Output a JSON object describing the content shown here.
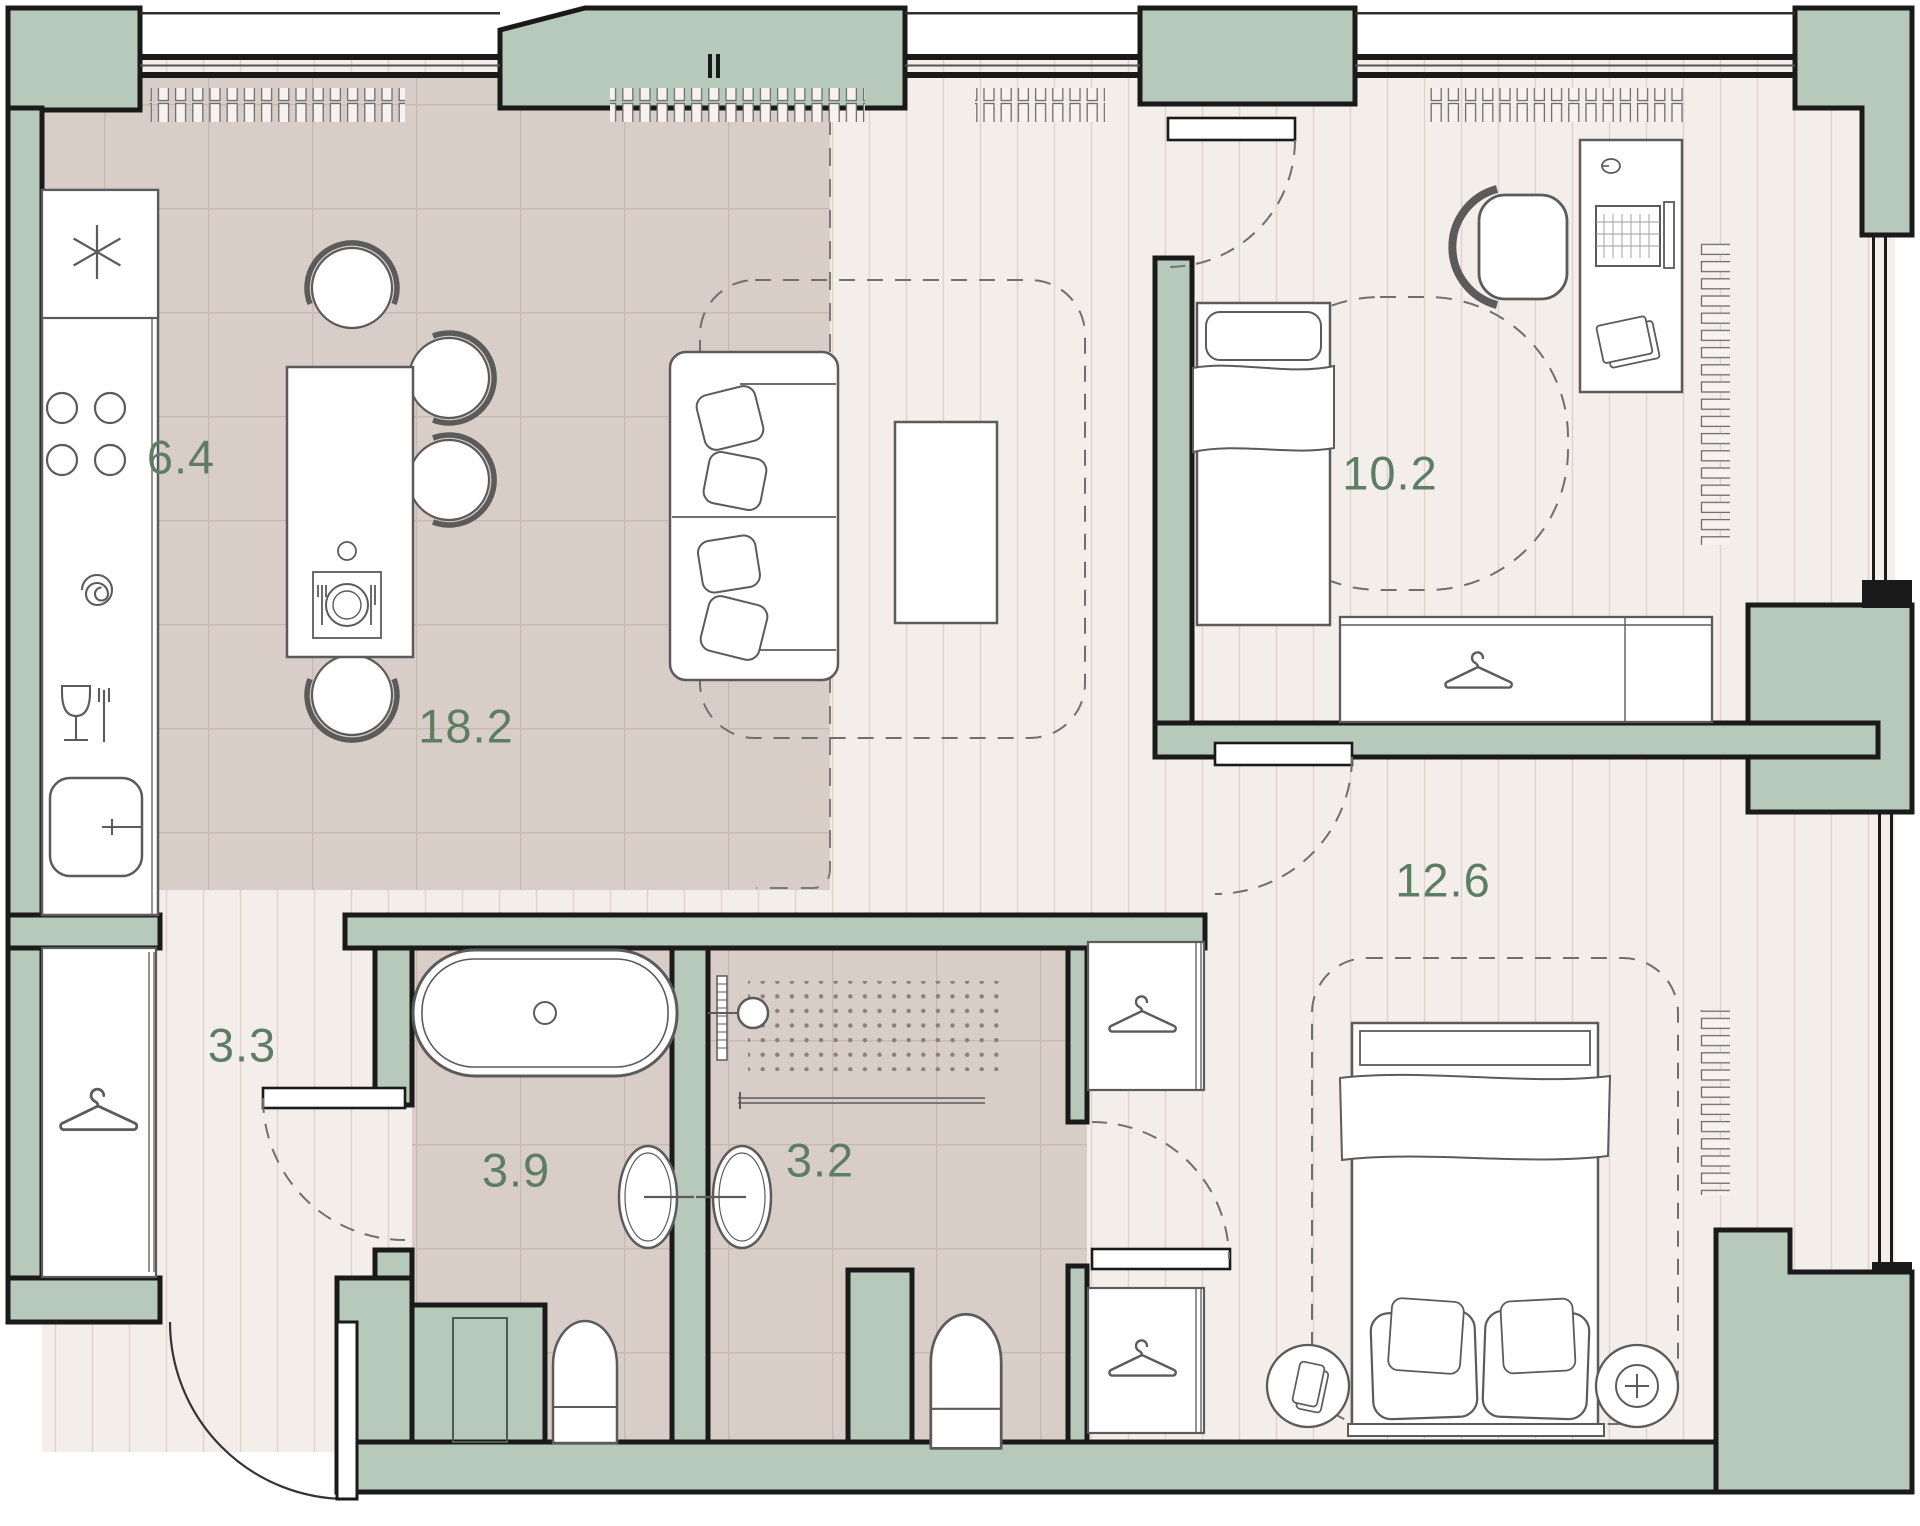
{
  "floor_plan": {
    "type": "apartment-floor-plan",
    "rooms": {
      "kitchen": {
        "area": "6.4",
        "fixtures": [
          "fridge-icon",
          "hob-icon",
          "oven-icon",
          "dishwasher-icon",
          "kitchen-sink-icon",
          "dining-table",
          "dining-chairs",
          "place-setting-icon"
        ]
      },
      "living": {
        "area": "18.2",
        "fixtures": [
          "sofa",
          "coffee-table",
          "rug-outline"
        ]
      },
      "bedroom_small": {
        "area": "10.2",
        "fixtures": [
          "single-bed",
          "desk",
          "laptop-icon",
          "office-chair",
          "wardrobe",
          "hanger-icon",
          "radiator"
        ]
      },
      "bedroom_master": {
        "area": "12.6",
        "fixtures": [
          "double-bed",
          "nightstand-phone",
          "nightstand-lamp",
          "wardrobe",
          "hanger-icon",
          "radiator"
        ]
      },
      "hallway": {
        "area": "3.3",
        "fixtures": [
          "closet",
          "hanger-icon",
          "entrance-door"
        ]
      },
      "bathroom": {
        "area": "3.9",
        "fixtures": [
          "bathtub",
          "washbasin",
          "toilet",
          "vent-duct"
        ]
      },
      "shower_room": {
        "area": "3.2",
        "fixtures": [
          "shower-head-icon",
          "shower-spray-area",
          "towel-rail",
          "washbasin",
          "toilet"
        ]
      }
    },
    "colors": {
      "walls": "#1a1a1a",
      "structure_fill": "#b7c9ba",
      "wood_floor": "#f4eeeb",
      "wood_stripe": "#ddd2cc",
      "tile_floor": "#d9cec7",
      "tile_grid": "#c7bab2",
      "furniture_stroke": "#5b5b5b",
      "dash_line": "#6f6f6f",
      "label_text": "#5e7e64"
    }
  }
}
